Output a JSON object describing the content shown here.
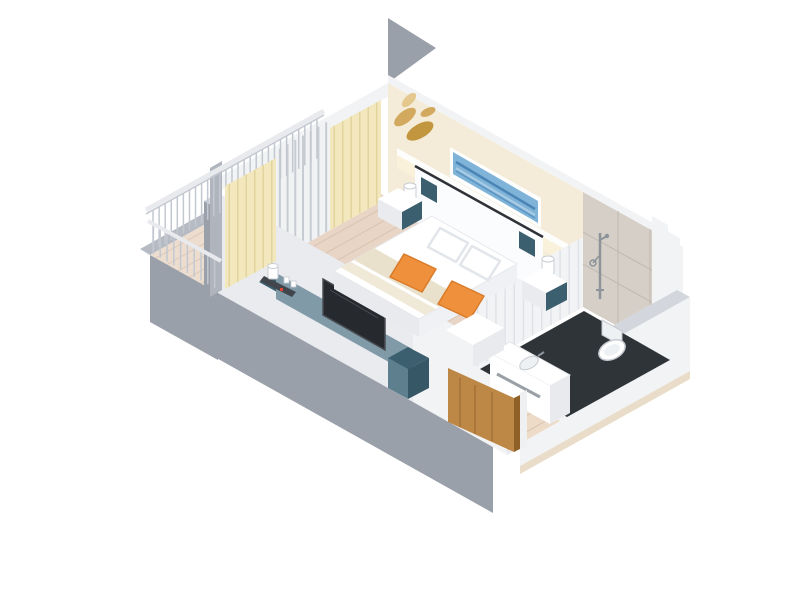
{
  "scene": {
    "description": "3D isometric cutaway render of a hotel guest room floor plan",
    "view": "isometric top-down cutaway, white background, no text labels",
    "areas": {
      "balcony": {
        "label": "balcony",
        "items": [
          "white-railing",
          "wood-decking",
          "cream-curtains",
          "glass-sliding-door"
        ]
      },
      "bedroom": {
        "label": "bedroom",
        "items": [
          "double-bed",
          "white-duvet",
          "beige-throw-stripes",
          "orange-accent-pillows",
          "white-headboard",
          "reading-lamps",
          "floating-nightstands",
          "teal-tv-console",
          "television",
          "coffee-station",
          "blue-abstract-artwork",
          "gold-leaf-wall-decor",
          "lit-wall-ledge",
          "wood-floor"
        ]
      },
      "bathroom": {
        "label": "en-suite bathroom",
        "items": [
          "marble-wall",
          "handheld-shower-set",
          "wall-hung-toilet",
          "white-vanity-with-basin",
          "dark-tile-floor",
          "ribbed-white-partition"
        ]
      },
      "entry": {
        "label": "entry hall",
        "items": [
          "open-wood-door",
          "wood-floor",
          "white-walls"
        ]
      }
    }
  },
  "palette": {
    "background": "#ffffff",
    "exterior_gray": "#9aa0a9",
    "exterior_gray_light": "#b0b5bd",
    "wall_cap": "#d3d6dc",
    "interior_white": "#f2f3f5",
    "interior_white_dim": "#e9ebef",
    "cream_wall": "#f4ecd8",
    "ledge_white": "#fdfdfb",
    "ledge_glow": "#f9f1da",
    "gold_leaf": "#d2a95f",
    "gold_leaf_light": "#e4c88e",
    "gold_leaf_dark": "#c2953f",
    "art_frame": "#ffffff",
    "art_blue": "#7fb3d8",
    "art_blue_dark": "#4a85b5",
    "art_blue_mid": "#5d95c2",
    "art_blue_light": "#aacce5",
    "curtain": "#f2e7bd",
    "curtain_fold": "#e2d49e",
    "glass_slat_bg": "#f1f2f4",
    "glass_slat": "#c7ccd3",
    "wood_floor": "#e8d5c6",
    "wood_plank": "#d9c2b0",
    "balcony_wood": "#ecddcf",
    "balcony_plank": "#ddc9ba",
    "entry_wood": "#eddbc8",
    "slab_edge": "#b6bbc3",
    "railing_bar": "#c3c8d0",
    "railing_rail": "#e8eaee",
    "console_top": "#3c5f70",
    "console_front": "#819aa8",
    "console_side": "#5d7f8e",
    "console_dark": "#355766",
    "tv_dark": "#26292e",
    "tv_frame": "#4a4e54",
    "tray_dark": "#41464c",
    "white_goods": "#ffffff",
    "goods_stroke": "#c9cdd3",
    "red_dot": "#e04434",
    "bed_white": "#ffffff",
    "bed_edge": "#e6e8eb",
    "bed_shadow": "#e8eaed",
    "bed_shadow2": "#eff1f4",
    "stripe_beige": "#eae1cc",
    "stripe_light": "#f0e9d8",
    "pillow_stroke": "#e2e5e9",
    "orange": "#ef913c",
    "orange_dark": "#d97a28",
    "headboard": "#fbfcfd",
    "headboard_trim": "#2f3237",
    "teal_accent": "#3c5f70",
    "marble": "#d5cfc7",
    "marble_line": "#c0b8ae",
    "bath_floor": "#2f3439",
    "porcelain": "#ffffff",
    "porcelain_shade": "#eef1f3",
    "porcelain_stroke": "#c6cad0",
    "slot_gray": "#9aa0a6",
    "chrome": "#8d939a",
    "door_wood": "#bd8746",
    "door_wood_dark": "#8f6028",
    "door_frame": "#eef0f2",
    "plinth": "#e9dcc9",
    "rib_line": "#dfe3e8"
  }
}
